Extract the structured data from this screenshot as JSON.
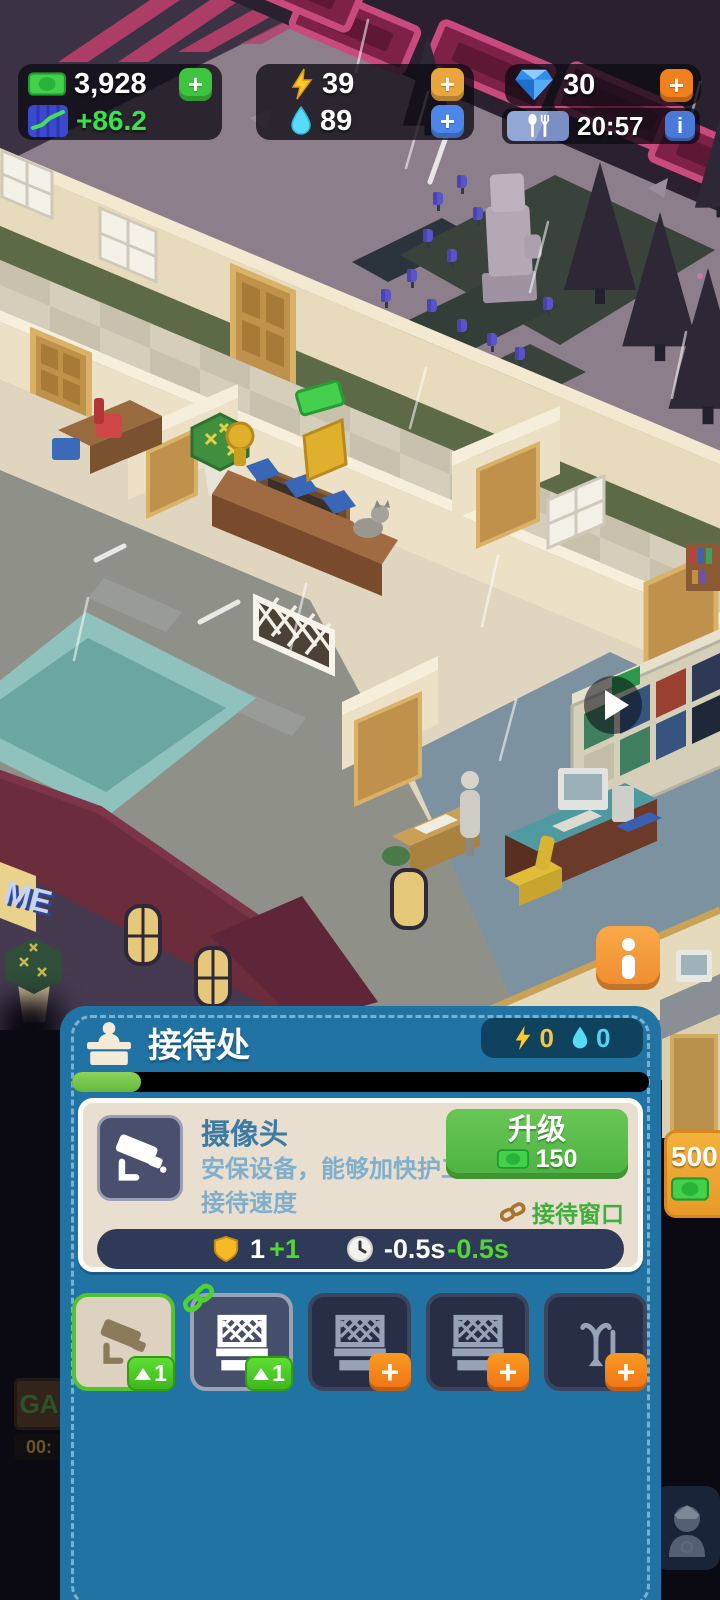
{
  "hud": {
    "money": "3,928",
    "income": "+86.2",
    "energy": "39",
    "water": "89",
    "gems": "30",
    "time": "20:57",
    "plus_label": "+",
    "info_label": "i"
  },
  "world": {
    "building_sign": "ME",
    "floor_item_price": "500",
    "dim_sign_text": "GA",
    "dim_sign_timer": "00:"
  },
  "panel": {
    "title": "接待处",
    "room_energy": "0",
    "room_water": "0",
    "progress_percent": 12,
    "card": {
      "name": "摄像头",
      "desc_line1": "安保设备，能够加快护工的",
      "desc_line2": "接待速度",
      "upgrade_label": "升级",
      "upgrade_cost": "150",
      "link_label": "接待窗口",
      "shield_value": "1",
      "shield_bonus": "+1",
      "time_value": "-0.5s",
      "time_bonus": "-0.5s"
    },
    "slots": [
      {
        "item": "security-camera",
        "badge": "1"
      },
      {
        "item": "reception-window",
        "badge": "1"
      },
      {
        "item": "reception-window",
        "badge": "+"
      },
      {
        "item": "reception-window",
        "badge": "+"
      },
      {
        "item": "coat-rack",
        "badge": "+"
      }
    ]
  },
  "colors": {
    "panel_blue": "#2173a4",
    "upgrade_green": "#55bb45",
    "accent_orange": "#f0862c",
    "money_green": "#3ec43e",
    "bonus_green": "#52d631",
    "energy_gold": "#f5c63f",
    "water_cyan": "#4fd4f2"
  }
}
